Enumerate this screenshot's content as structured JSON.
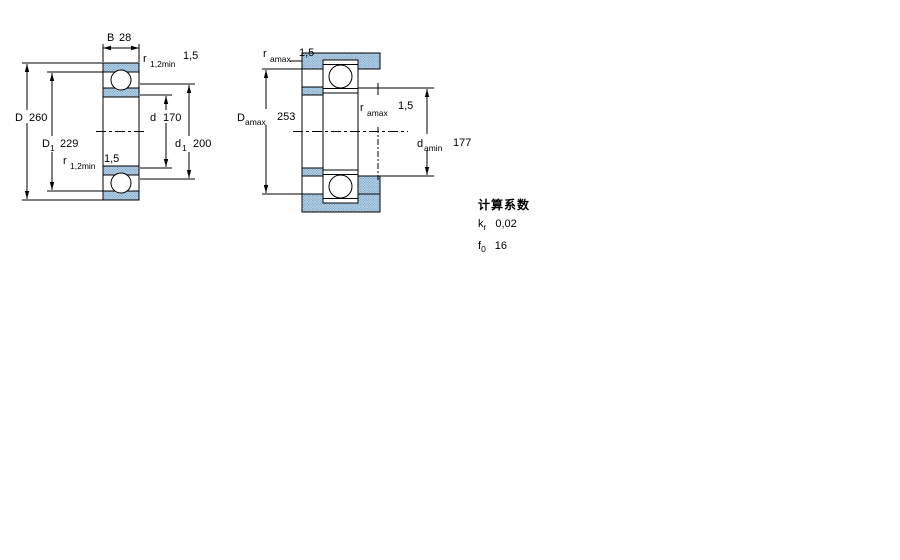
{
  "colors": {
    "hatch_fill": "#b9d3e7",
    "hatch_dot": "#6b98be",
    "line": "#000000"
  },
  "left_drawing": {
    "b_width": {
      "main": "B",
      "value": "28"
    },
    "r_top": {
      "main": "r",
      "sub": "1,2min",
      "value": "1,5"
    },
    "d_outer": {
      "main": "D",
      "value": "260"
    },
    "d1_shoulder": {
      "main": "D",
      "sub": "1",
      "value": "229"
    },
    "r_bottom": {
      "main": "r",
      "sub": "1,2min",
      "value": "1,5"
    },
    "d_bore": {
      "main": "d",
      "value": "170"
    },
    "d1_inner": {
      "main": "d",
      "sub": "1",
      "value": "200"
    }
  },
  "right_drawing": {
    "r_amax_top": {
      "main": "r",
      "sub": "amax",
      "value": "1,5"
    },
    "d_amax": {
      "main": "D",
      "sub": "amax",
      "value": "253"
    },
    "r_amax_mid": {
      "main": "r",
      "sub": "amax",
      "value": "1,5"
    },
    "d_amin": {
      "main": "d",
      "sub": "amin",
      "value": "177"
    }
  },
  "calc_factors": {
    "heading": "计算系数",
    "rows": [
      {
        "main": "k",
        "sub": "r",
        "value": "0,02"
      },
      {
        "main": "f",
        "sub": "0",
        "value": "16"
      }
    ]
  }
}
